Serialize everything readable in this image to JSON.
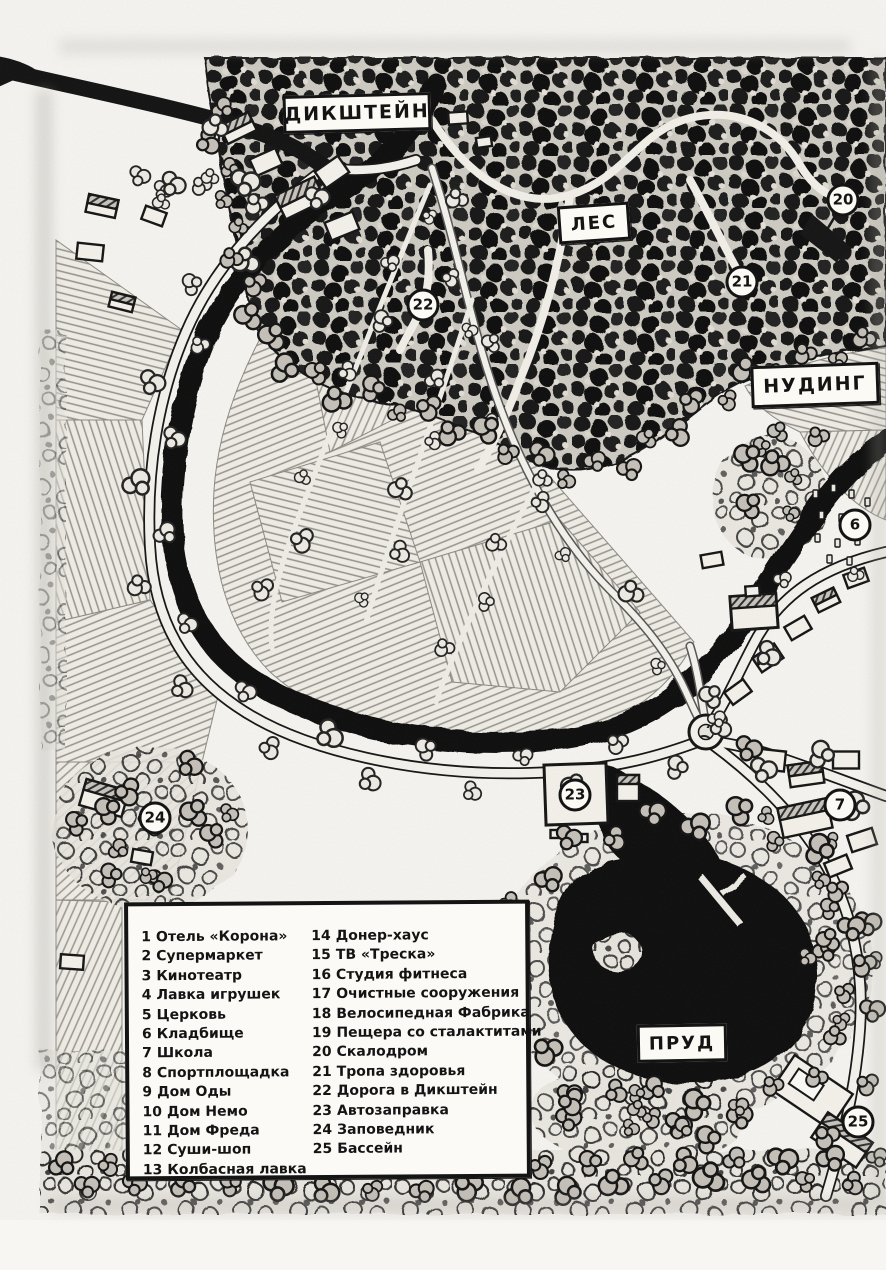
{
  "map": {
    "type": "hand-drawn village map",
    "colors": {
      "ink": "#141414",
      "paper": "#f7f6f2",
      "water": "#0d0d0d",
      "pencil": "#97948c"
    }
  },
  "places": {
    "dikstein": {
      "label": "ДИКШТЕЙН"
    },
    "forest": {
      "label": "ЛЕС"
    },
    "nuding": {
      "label": "НУДИНГ"
    },
    "pond": {
      "label": "ПРУД"
    }
  },
  "markers": {
    "m20": {
      "num": "20"
    },
    "m21": {
      "num": "21"
    },
    "m22": {
      "num": "22"
    },
    "m6": {
      "num": "6"
    },
    "m7": {
      "num": "7"
    },
    "m23": {
      "num": "23"
    },
    "m24": {
      "num": "24"
    },
    "m25": {
      "num": "25"
    }
  },
  "legend": {
    "column_split": 13,
    "items": [
      {
        "num": "1",
        "label": "Отель «Корона»"
      },
      {
        "num": "2",
        "label": "Супермаркет"
      },
      {
        "num": "3",
        "label": "Кинотеатр"
      },
      {
        "num": "4",
        "label": "Лавка игрушек"
      },
      {
        "num": "5",
        "label": "Церковь"
      },
      {
        "num": "6",
        "label": "Кладбище"
      },
      {
        "num": "7",
        "label": "Школа"
      },
      {
        "num": "8",
        "label": "Спортплощадка"
      },
      {
        "num": "9",
        "label": "Дом Оды"
      },
      {
        "num": "10",
        "label": "Дом Немо"
      },
      {
        "num": "11",
        "label": "Дом Фреда"
      },
      {
        "num": "12",
        "label": "Суши-шоп"
      },
      {
        "num": "13",
        "label": "Колбасная лавка"
      },
      {
        "num": "14",
        "label": "Донер-хаус"
      },
      {
        "num": "15",
        "label": "ТВ «Треска»"
      },
      {
        "num": "16",
        "label": "Студия фитнеса"
      },
      {
        "num": "17",
        "label": "Очистные сооружения"
      },
      {
        "num": "18",
        "label": "Велосипедная Фабрика"
      },
      {
        "num": "19",
        "label": "Пещера со сталактитами"
      },
      {
        "num": "20",
        "label": "Скалодром"
      },
      {
        "num": "21",
        "label": "Тропа здоровья"
      },
      {
        "num": "22",
        "label": "Дорога в Дикштейн"
      },
      {
        "num": "23",
        "label": "Автозаправка"
      },
      {
        "num": "24",
        "label": "Заповедник"
      },
      {
        "num": "25",
        "label": "Бассейн"
      }
    ]
  }
}
